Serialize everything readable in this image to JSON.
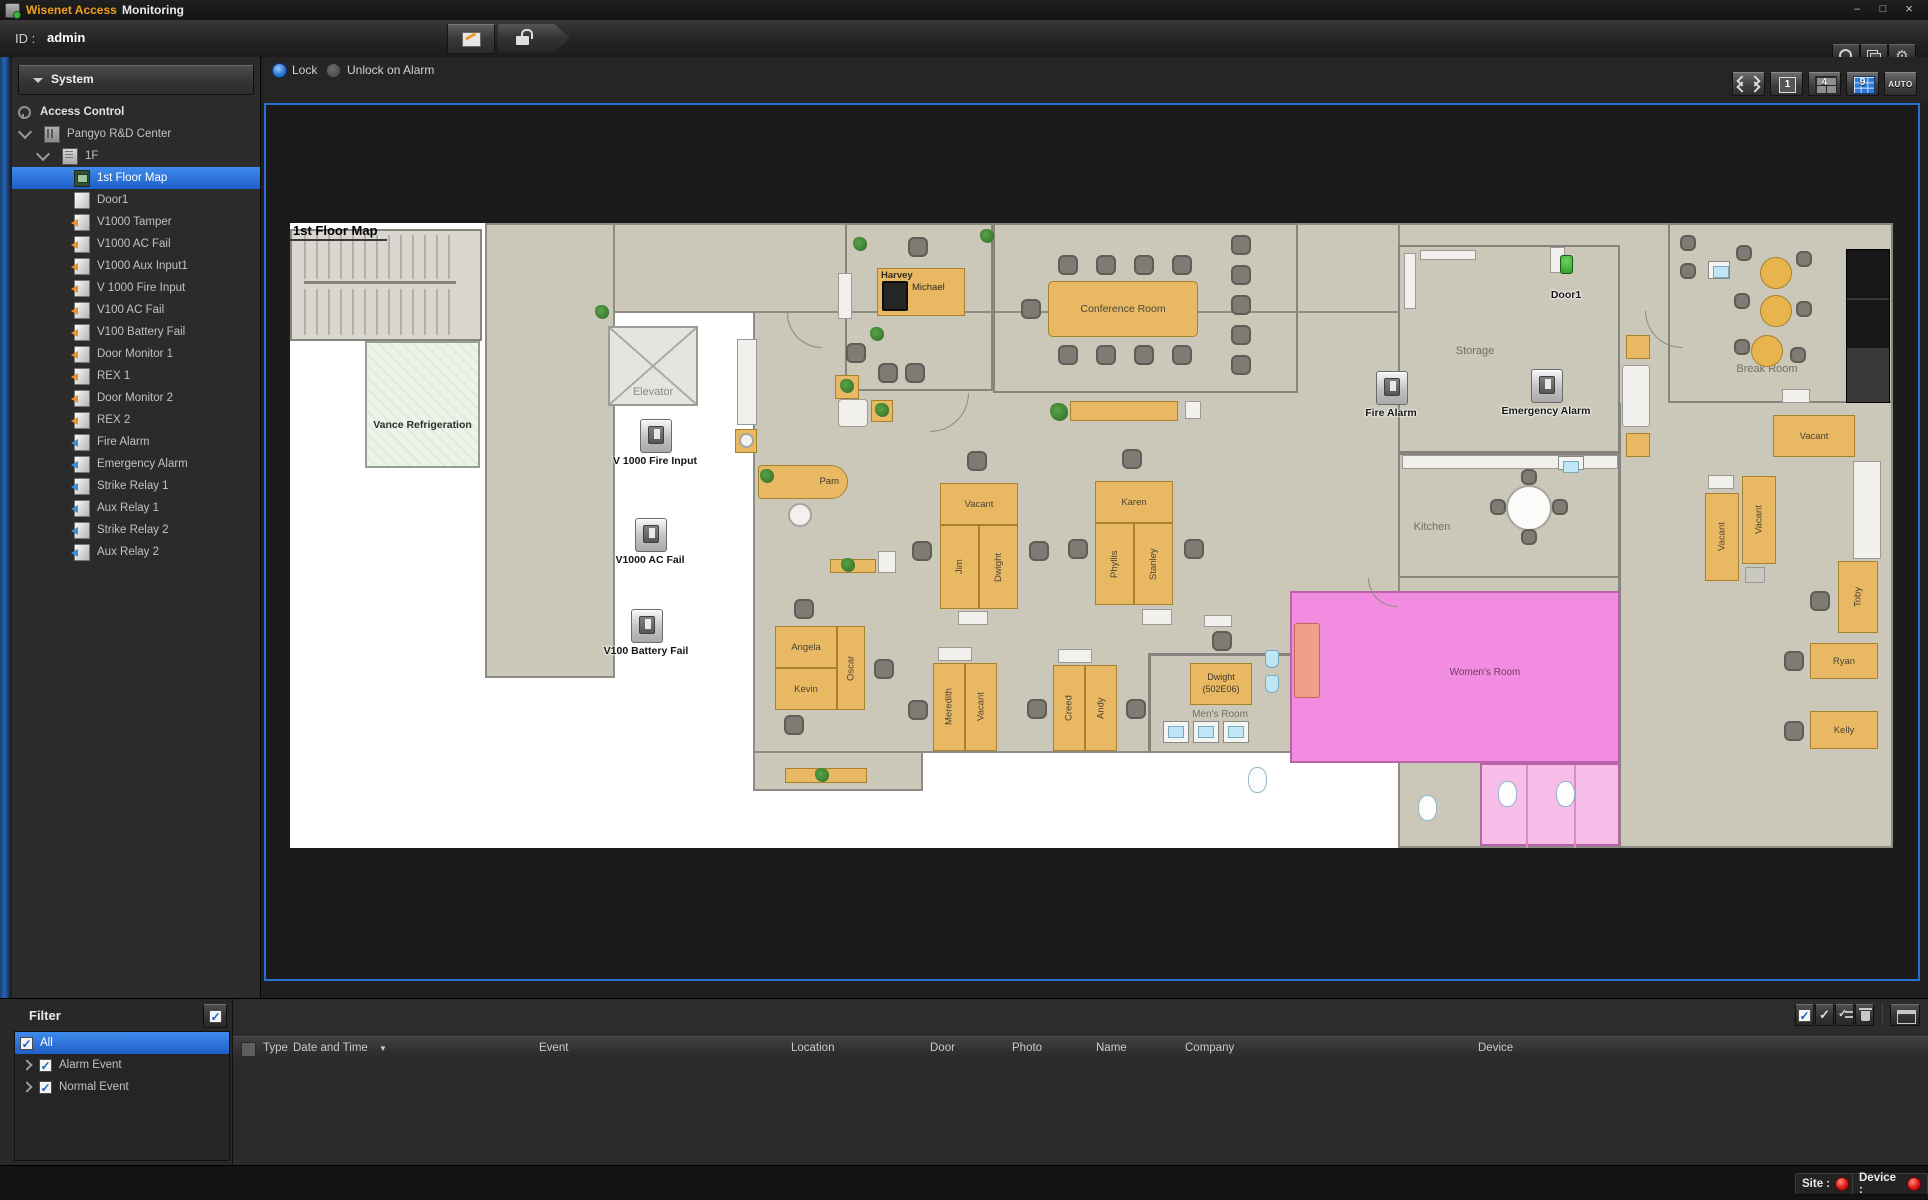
{
  "window": {
    "brand": "Wisenet Access",
    "app": "Monitoring"
  },
  "toolbar": {
    "id_label": "ID :",
    "id_value": "admin"
  },
  "icons": {
    "gear": "⚙",
    "check": "✓",
    "sort_desc": "▼",
    "min": "–",
    "max": "□",
    "close": "×"
  },
  "sidebar": {
    "header": "System",
    "root": "Access Control",
    "items": [
      {
        "label": "Pangyo R&D Center"
      },
      {
        "label": "1F"
      },
      {
        "label": "1st Floor Map"
      },
      {
        "label": "Door1"
      },
      {
        "label": "V1000 Tamper"
      },
      {
        "label": "V1000 AC Fail"
      },
      {
        "label": "V1000 Aux Input1"
      },
      {
        "label": "V 1000 Fire Input"
      },
      {
        "label": "V100 AC Fail"
      },
      {
        "label": "V100 Battery Fail"
      },
      {
        "label": "Door Monitor 1"
      },
      {
        "label": "REX 1"
      },
      {
        "label": "Door Monitor 2"
      },
      {
        "label": "REX 2"
      },
      {
        "label": "Fire Alarm"
      },
      {
        "label": "Emergency Alarm"
      },
      {
        "label": "Strike Relay 1"
      },
      {
        "label": "Aux Relay 1"
      },
      {
        "label": "Strike Relay 2"
      },
      {
        "label": "Aux Relay 2"
      }
    ]
  },
  "map_toolbar": {
    "lock": "Lock",
    "unlock": "Unlock on Alarm",
    "view_1": "1",
    "view_4": "4",
    "view_9": "9",
    "view_auto": "AUTO"
  },
  "map": {
    "title": "1st Floor Map",
    "rooms": {
      "vance": "Vance Refrigeration",
      "elevator": "Elevator",
      "conference": "Conference Room",
      "storage": "Storage",
      "break_room": "Break Room",
      "kitchen": "Kitchen",
      "mens": "Men's Room",
      "womens": "Women's Room"
    },
    "desks": {
      "harvey": "Harvey",
      "michael": "Michael",
      "pam": "Pam",
      "c1_top": "Vacant",
      "c1_left": "Jim",
      "c1_right": "Dwight",
      "c2_top": "Karen",
      "c2_left": "Phyllis",
      "c2_right": "Stanley",
      "c3_top": "Angela",
      "c3_bottom": "Kevin",
      "c3_right": "Oscar",
      "c4_left": "Meredith",
      "c4_right": "Vacant",
      "c5_left": "Creed",
      "c5_right": "Andy",
      "dwight_office_l1": "Dwight",
      "dwight_office_l2": "(502E06)",
      "vacant_h": "Vacant",
      "vacant_v1": "Vacant",
      "vacant_v2": "Vacant",
      "toby": "Toby",
      "ryan": "Ryan",
      "kelly": "Kelly"
    },
    "devices": [
      {
        "label": "V 1000 Fire Input"
      },
      {
        "label": "V1000 AC Fail"
      },
      {
        "label": "V100 Battery Fail"
      },
      {
        "label": "Fire Alarm"
      },
      {
        "label": "Emergency Alarm"
      },
      {
        "label": "Door1"
      }
    ]
  },
  "filter": {
    "title": "Filter",
    "items": [
      {
        "label": "All"
      },
      {
        "label": "Alarm Event"
      },
      {
        "label": "Normal Event"
      }
    ]
  },
  "table": {
    "columns": [
      "Type",
      "Date and Time",
      "Event",
      "Location",
      "Door",
      "Photo",
      "Name",
      "Company",
      "Device"
    ]
  },
  "status": {
    "site_label": "Site :",
    "device_label": "Device :"
  },
  "colors": {
    "accent_blue": "#2f7bd8",
    "brand_orange": "#f09e1e",
    "alert_red": "#e01818",
    "desk_orange": "#e8b862",
    "room_pink": "#f28ce0"
  }
}
